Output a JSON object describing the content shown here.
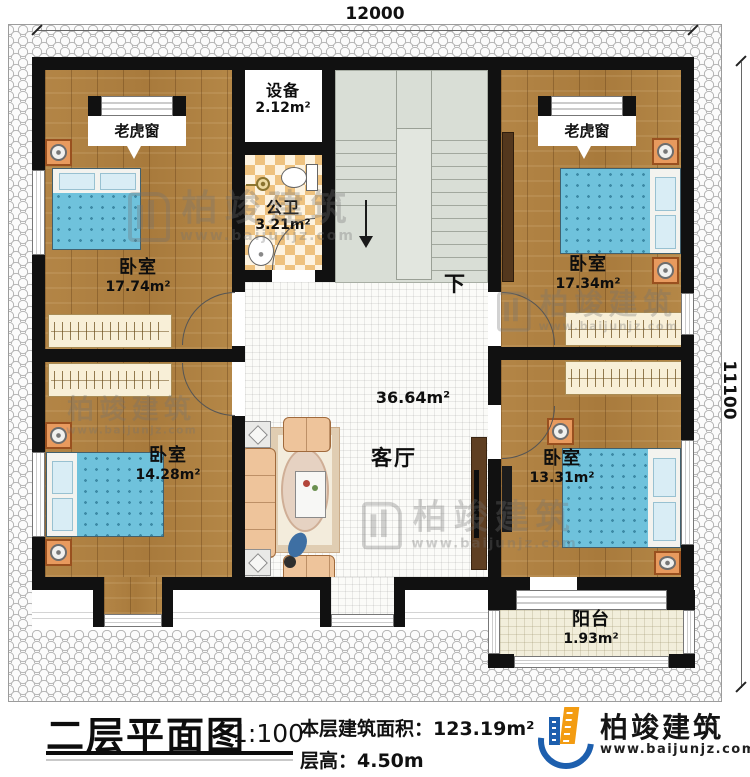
{
  "dimensions": {
    "width": "12000",
    "height": "11100"
  },
  "rooms": {
    "bedroom_top_left": {
      "name": "卧室",
      "area": "17.74m²"
    },
    "bedroom_top_right": {
      "name": "卧室",
      "area": "17.34m²"
    },
    "bedroom_bottom_left": {
      "name": "卧室",
      "area": "14.28m²"
    },
    "bedroom_bottom_right": {
      "name": "卧室",
      "area": "13.31m²"
    },
    "equipment": {
      "name": "设备",
      "area": "2.12m²"
    },
    "bathroom": {
      "name": "公卫",
      "area": "3.21m²"
    },
    "living_room": {
      "name": "客厅",
      "area": "36.64m²"
    },
    "balcony": {
      "name": "阳台",
      "area": "1.93m²"
    },
    "dormer_left": {
      "name": "老虎窗"
    },
    "dormer_right": {
      "name": "老虎窗"
    },
    "stairs": {
      "down_label": "下"
    }
  },
  "legend": {
    "title": "二层平面图",
    "scale": "1:100",
    "floor_area_label": "本层建筑面积：",
    "floor_area_value": "123.19m²",
    "floor_height_label": "层高：",
    "floor_height_value": "4.50m"
  },
  "watermark": {
    "name": "柏竣建筑",
    "url": "www.baijunjz.com"
  },
  "brand": {
    "name": "柏竣建筑",
    "url": "www.baijunjz.com",
    "blue": "#1d5fae",
    "orange": "#f39c12"
  },
  "colors": {
    "wall": "#111111",
    "wood_floor": "#b08142",
    "bed_blanket": "#6fc2dc",
    "tile_checker": "#eec27f",
    "stairs": "#d9ded6",
    "balcony_floor": "#f2eedb"
  }
}
